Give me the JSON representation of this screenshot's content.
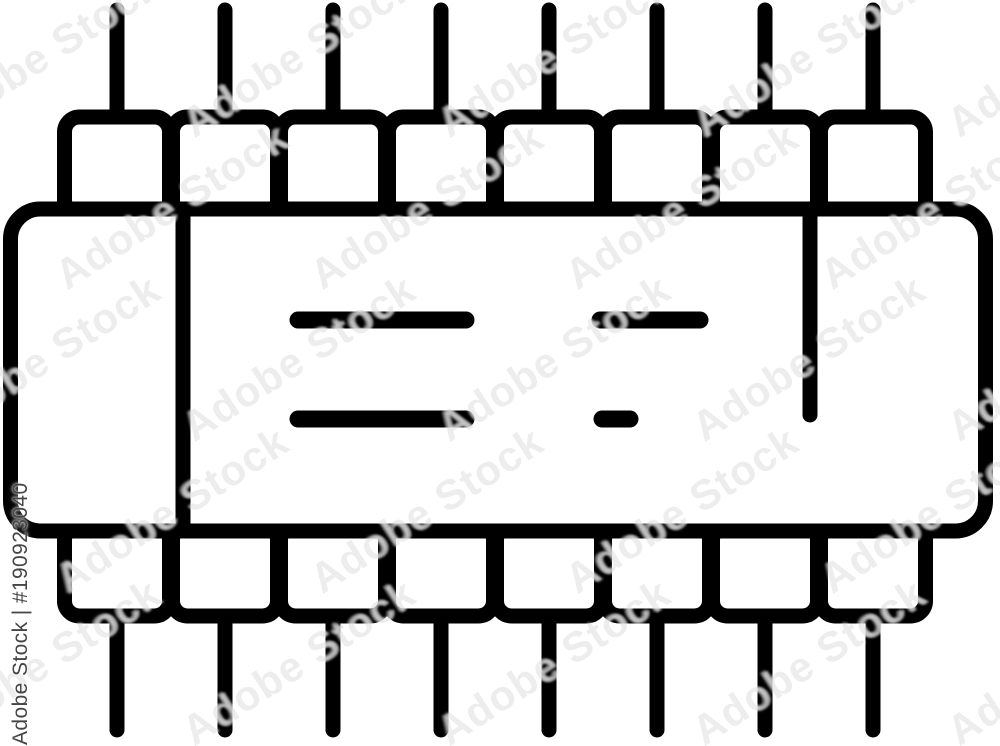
{
  "colors": {
    "background": "#ffffff",
    "icon": "#000000",
    "watermark_text": "#454545"
  },
  "chip": {
    "icon_name": "microchip-icon",
    "pins_top": 8,
    "pins_bottom": 8,
    "surface_marking_lines": 4,
    "has_left_divider": true,
    "has_pin1_indicator": true
  },
  "watermark": {
    "label": "Adobe Stock | #190923040",
    "tile_text": "Adobe Stock"
  }
}
